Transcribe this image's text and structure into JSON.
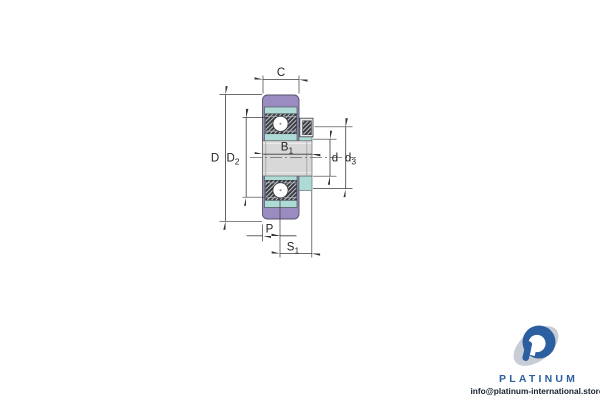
{
  "diagram": {
    "type": "bearing cross-section technical drawing",
    "dimension_labels": {
      "C": {
        "base": "C",
        "sub": ""
      },
      "D": {
        "base": "D",
        "sub": ""
      },
      "D2": {
        "base": "D",
        "sub": "2"
      },
      "B1": {
        "base": "B",
        "sub": "1"
      },
      "d": {
        "base": "d",
        "sub": ""
      },
      "d3": {
        "base": "d",
        "sub": "3"
      },
      "P": {
        "base": "P",
        "sub": ""
      },
      "S1": {
        "base": "S",
        "sub": "1"
      }
    },
    "colors": {
      "housing_purple": "#9a8cc1",
      "insert_teal": "#aedbd5",
      "bore_gray": "#d8d8d8",
      "race_dark": "#3b3b43",
      "line": "#3d3d3d"
    }
  },
  "watermark": {
    "brand": "PLATINUM",
    "email": "info@platinum-international.store",
    "brand_color": "#2b5f9f",
    "logo_blue": "#2b5f9f",
    "logo_gray": "#c7ccd5"
  }
}
